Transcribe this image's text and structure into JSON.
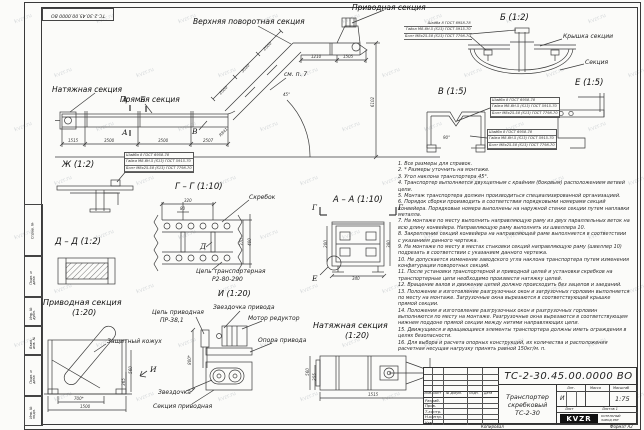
{
  "watermark": "kvzr.ru",
  "frame": {
    "doc_number_top": "ТС-2-30.45.00.0000 ВО",
    "side_labels": [
      "Справ. №",
      "Подп. и дата",
      "Инв. № дубл.",
      "Взам. инв. №",
      "Подп. и дата",
      "Инв. № подл."
    ],
    "copied_label": "Копировал",
    "format_label": "Формат А2"
  },
  "main_view": {
    "labels": {
      "upper_turn": "Верхняя поворотная секция",
      "drive": "Приводная секция",
      "tension": "Натяжная секция",
      "straight": "Прямая секция",
      "see_note": "см. п. 7"
    },
    "marks": {
      "a": "А",
      "b": "Б",
      "v": "В"
    },
    "dims": {
      "bottom": [
        "1515",
        "3500",
        "3500",
        "2507"
      ],
      "incline": [
        "2000",
        "3030",
        "2000"
      ],
      "top": [
        "1210",
        "1505"
      ],
      "height": "6102",
      "angle": "45°",
      "radius": "R841"
    }
  },
  "fastener": [
    "Шайба 8 ГОСТ 6958-78",
    "Гайка М8-6Н.5 (S13) ГОСТ 5915-70",
    "Болт М8х25.58 (S13) ГОСТ 7798-70"
  ],
  "views": {
    "b": {
      "title": "Б (1:2)",
      "cover": "Крышка секции",
      "section": "Секция"
    },
    "v": {
      "title": "В (1:5)",
      "angle": "90°"
    },
    "e": {
      "title": "Е (1:5)"
    },
    "zh": {
      "title": "Ж (1:2)"
    },
    "gg": {
      "title": "Г – Г (1:10)",
      "scraper": "Скребок",
      "chain_l1": "Цепь транспортерная",
      "chain_l2": "Р2-80-290",
      "mark_d": "Д",
      "dims": [
        "320",
        "80",
        "370",
        "400"
      ]
    },
    "aa": {
      "title": "А – А (1:10)",
      "mark_g": "Г",
      "mark_e": "Е",
      "dims": [
        "200",
        "380",
        "340"
      ]
    },
    "dd": {
      "title": "Д – Д (1:2)"
    },
    "drive": {
      "title_l1": "Приводная секция",
      "title_l2": "(1:20)",
      "cover": "Защитный кожух",
      "mark_i": "И",
      "dims": [
        "700*",
        "1500",
        "560",
        "365"
      ]
    },
    "i": {
      "title": "И (1:20)",
      "chain_l1": "Цепь приводная",
      "chain_l2": "ПР-38,1",
      "sprocket_drive": "Звездочка привода",
      "motor": "Мотор редуктор",
      "support": "Опора привода",
      "sprocket": "Звездочка",
      "section": "Секция приводная",
      "dim": "800*"
    },
    "tension": {
      "title_l1": "Натяжная секция",
      "title_l2": "(1:20)",
      "dims": [
        "1515",
        "560",
        "255"
      ]
    }
  },
  "notes": [
    "1. Все размеры для справок.",
    "2. * Размеры уточнить на монтаже.",
    "3. Угол наклона транспортера 45°.",
    "4. Транспортер выполняется двухцепным с крайним (боковым) расположением ветвей цепи.",
    "5. Монтаж транспортера должен производиться специализированной организацией.",
    "6. Порядок сборки производить в соответствии порядковыми номерами секций конвейера. Порядковые номера выполнены на наружной стенке секции путем наплавки металла.",
    "7. На монтаже по месту выполнить направляющую раму из двух параллельных веток на всю длину конвейера. Направляющую раму выполнять из швеллера 10.",
    "8. Закрепление секций конвейера на направляющей раме выполняется в соответствии с указанием данного чертежа.",
    "9. На монтаже по месту в местах стыковки секций направляющую раму (швеллер 10) подрезать в соответствии с указанием данного чертежа.",
    "10. Не допускается изменение заводского угла наклона транспортера путем изменения конфигурации поворотных секций.",
    "11. После установки транспортерной и приводной цепей и установки скребков на транспортерные цепи необходимо произвести натяжку цепей.",
    "12. Вращение валов и движение цепей должно происходить без зацепов и заеданий.",
    "13. Положение и изготовление разгрузочных окон и загрузочных горловин выполняется по месту на монтаже. Загрузочные окна вырезаются в соответствующей крышке прямой секции.",
    "14. Положения и изготовление разгрузочных окон и разгрузочных горловин выполняются по месту на монтаже. Разгрузочные окна вырезаются в соответствующем нижнем поддоне прямой секции между нитями направляющих цепи.",
    "15. Движущиеся и вращающиеся элементы транспортера должны иметь ограждения в целях безопасности.",
    "16. Для выбора и расчета опорных конструкций, их количества и расположения расчетная несущая нагрузку принять равной 150кг/м. п."
  ],
  "title_block": {
    "doc_number": "ТС-2-30.45.00.0000  ВО",
    "name_l1": "Транспортер",
    "name_l2": "скребковый",
    "name_l3": "ТС-2-30",
    "liter_header": "Лит.",
    "mass_header": "Масса",
    "scale_header": "Масштаб",
    "liter": "И",
    "scale": "1:75",
    "sheet_label": "Лист",
    "sheets_label": "Листов 1",
    "rows": [
      "Разраб.",
      "Пров.",
      "Т.контр.",
      "Н.контр.",
      "Утв."
    ],
    "cols": [
      "Изм.",
      "Лист",
      "№ докум.",
      "Подп.",
      "Дата"
    ],
    "logo": "KVZR",
    "company_l1": "КОТЕЛЬНЫЙ",
    "company_l2": "ЗАВОД РЭР"
  }
}
